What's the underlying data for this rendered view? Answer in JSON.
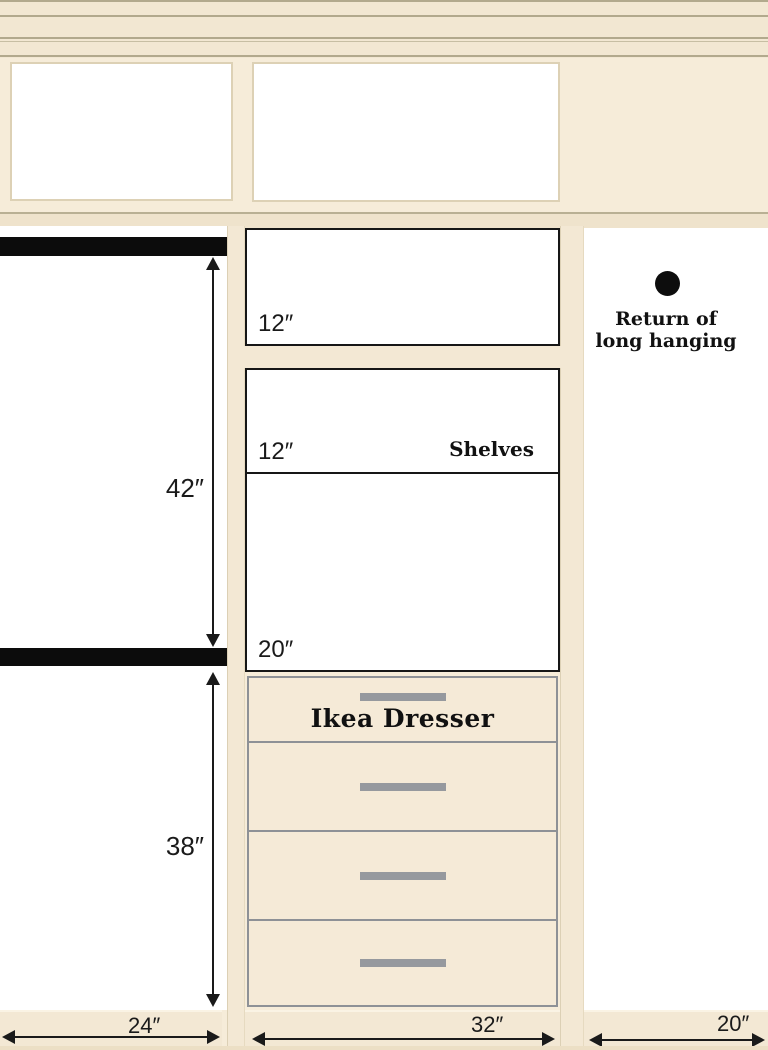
{
  "left_bay": {
    "upper_height_label": "42″",
    "lower_height_label": "38″",
    "width_label": "24″"
  },
  "center_bay": {
    "shelf_labels": [
      "12″",
      "12″",
      "20″"
    ],
    "shelves_caption": "Shelves",
    "dresser_caption": "Ikea Dresser",
    "drawer_count": 4,
    "width_label": "32″"
  },
  "right_bay": {
    "caption_line1": "Return of",
    "caption_line2": "long hanging",
    "width_label": "20″"
  },
  "colors": {
    "wall_cream": "#f6ecd9",
    "panel_white": "#ffffff",
    "rod_black": "#0d0d0d",
    "dresser_outline_gray": "#8e9196",
    "drawer_handle_gray": "#96999e",
    "molding_line_olive": "#b2a98d"
  }
}
